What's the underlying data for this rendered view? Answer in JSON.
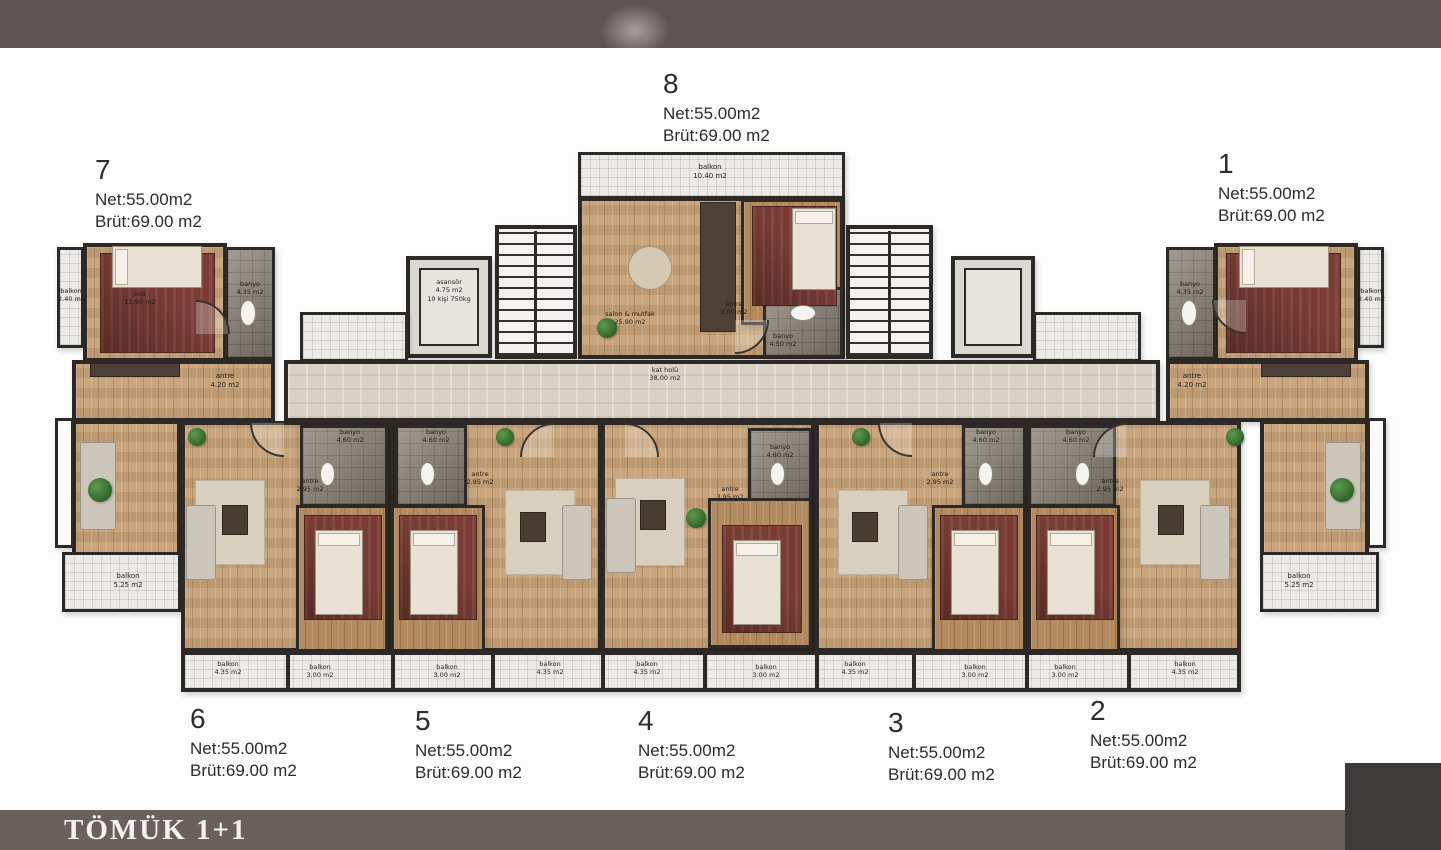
{
  "banner": {
    "title": "TÖMÜK 1+1",
    "background": "#6a605d"
  },
  "header_band": {
    "color": "#5d5553"
  },
  "corner_box": {
    "color": "#3e3a3a"
  },
  "units": {
    "u1": {
      "number": "1",
      "net": "Net:55.00m2",
      "brut": "Brüt:69.00 m2"
    },
    "u2": {
      "number": "2",
      "net": "Net:55.00m2",
      "brut": "Brüt:69.00 m2"
    },
    "u3": {
      "number": "3",
      "net": "Net:55.00m2",
      "brut": "Brüt:69.00 m2"
    },
    "u4": {
      "number": "4",
      "net": "Net:55.00m2",
      "brut": "Brüt:69.00 m2"
    },
    "u5": {
      "number": "5",
      "net": "Net:55.00m2",
      "brut": "Brüt:69.00 m2"
    },
    "u6": {
      "number": "6",
      "net": "Net:55.00m2",
      "brut": "Brüt:69.00 m2"
    },
    "u7": {
      "number": "7",
      "net": "Net:55.00m2",
      "brut": "Brüt:69.00 m2"
    },
    "u8": {
      "number": "8",
      "net": "Net:55.00m2",
      "brut": "Brüt:69.00 m2"
    }
  },
  "rooms": {
    "kat_holu": {
      "name": "kat holü",
      "area": "38.00 m2"
    },
    "asansor": {
      "name": "asansör",
      "area": "4.75 m2",
      "capacity": "10 kişi 750kg"
    },
    "salon_mutfak": {
      "name": "salon & mutfak",
      "area": "25.90 m2"
    },
    "oda": {
      "name": "oda",
      "area": "11.90 m2"
    },
    "balkon_1040": {
      "name": "balkon",
      "area": "10.40 m2"
    },
    "balkon_525": {
      "name": "balkon",
      "area": "5.25 m2"
    },
    "balkon_435": {
      "name": "balkon",
      "area": "4.35 m2"
    },
    "balkon_300": {
      "name": "balkon",
      "area": "3.00 m2"
    },
    "balkon_240": {
      "name": "balkon",
      "area": "2.40 m2"
    },
    "banyo_450": {
      "name": "banyo",
      "area": "4.50 m2"
    },
    "banyo_460": {
      "name": "banyo",
      "area": "4.60 m2"
    },
    "banyo_435": {
      "name": "banyo",
      "area": "4.35 m2"
    },
    "antre_420": {
      "name": "antre",
      "area": "4.20 m2"
    },
    "antre_295": {
      "name": "antre",
      "area": "2.95 m2"
    },
    "antre_395": {
      "name": "antre",
      "area": "3.95 m2"
    },
    "antre_200": {
      "name": "antre",
      "area": "2.00 m2"
    }
  }
}
